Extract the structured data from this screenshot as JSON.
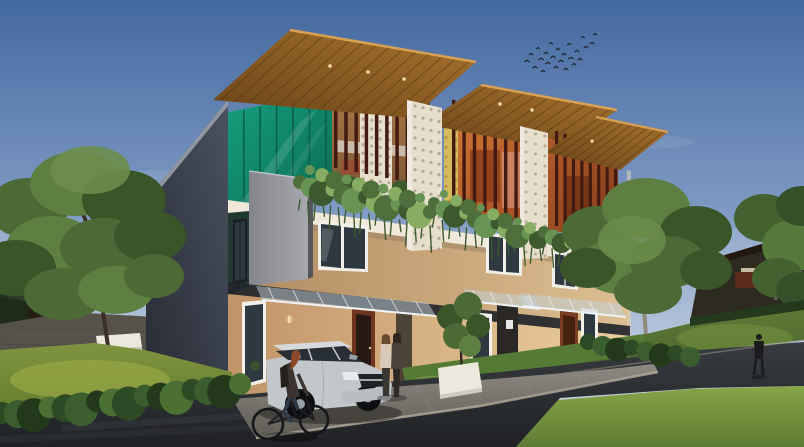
{
  "scene": {
    "type": "architectural-render",
    "description": "Exterior 3D rendering of a modern three-unit row house at dusk: rooftop wooden pergolas with maroon vertical louvers, teal glass panels, perforated breeze-block screens, hanging balcony vines, tan walls, dark slate side wall, glass entrance canopies, lawns and hedges, a silver SUV parked on the driveway, a cyclist on the road, two women at the entrance, a pedestrian on the far path and a flock of birds in the sky"
  },
  "palette": {
    "sky_top": "#44699f",
    "sky_mid": "#7b98c2",
    "sky_low": "#b9c9dc",
    "sky_horizon": "#cfd9e4",
    "cloud": "#ffffff",
    "bird": "#222a38",
    "ridge_dark": "#2d2a20",
    "ridge_top": "#211811",
    "distant_building": "#5a2b1d",
    "backdrop_tree": "#243420",
    "side_wall_top": "#4a5260",
    "side_wall_bottom": "#262a33",
    "roof_trim": "#99a0aa",
    "wood_light": "#a8742f",
    "wood_dark": "#6b4418",
    "wood_slat_line": "#53340f",
    "wood_fascia": "#d9a052",
    "louver": "#431a12",
    "teal_light": "#14a07e",
    "teal_dark": "#0c6b54",
    "teal_mullion": "#0a5844",
    "terrace1_warm": "#a87848",
    "terrace1_shadow": "#7c5636",
    "interior_orange": "#cf7a34",
    "interior_orange_dark": "#9a4420",
    "interior3_orange": "#b25a28",
    "interior3_dark": "#7e3a1a",
    "breeze_block": "#e7dfcb",
    "breeze_hole": "#a89f8a",
    "yellow_block": "#d4b95e",
    "yellow_hole": "#a8883a",
    "slab_white": "#f0e9da",
    "slab_shadow": "#9c8468",
    "gray_box_light": "#a6a8ad",
    "gray_box_dark": "#84868c",
    "tan_light": "#dcbf92",
    "tan_dark": "#b28a60",
    "gf_light": "#eccf9e",
    "gf_dark": "#c09468",
    "recess_dark": "#23262c",
    "awning_glass": "#c4d4de",
    "awning_frame": "#eef2f4",
    "door_maroon": "#70351f",
    "door_dark": "#2b2724",
    "window_frame": "#f2efe8",
    "window_glass": "#2e3840",
    "vine_a": "#4e6f3c",
    "vine_b": "#679454",
    "vine_c": "#3c5a2e",
    "vine_d": "#86ad62",
    "tree_a": "#4c6a36",
    "tree_b": "#5d7f42",
    "tree_c": "#3a5628",
    "tree_d": "#6b8d4a",
    "trunk_dark": "#3a2f24",
    "trunk_pale": "#8f897c",
    "lawn_left_hi": "#a3b148",
    "lawn_left": "#7f9440",
    "lawn_left_lo": "#667e2e",
    "lawn_right": "#5f7c38",
    "lawn_right_lo": "#49652c",
    "grass_front_hi": "#86a648",
    "grass_front_lo": "#5d7c33",
    "hedge_a": "#2c4a24",
    "hedge_b": "#3a5e2e",
    "hedge_c": "#223a1b",
    "hedge_hi": "#4a7034",
    "road_light": "#383c40",
    "road_dark": "#1f2124",
    "paver_light": "#8e8a82",
    "paver_dark": "#5f5c56",
    "curb": "#b5ad9e",
    "patio": "#56524a",
    "bench_white": "#ece8de",
    "car_silver_hi": "#d6dadd",
    "car_silver": "#c2c7cb",
    "car_silver_lo": "#9aa0a6",
    "car_glass": "#272e36",
    "car_tire": "#0d0e10",
    "skin": "#caa58a",
    "hair_red": "#8a4a28",
    "figure_dark": "#2c2824",
    "figure_light_top": "#d9c9b8",
    "lamp_glow": "#f5deaa"
  },
  "counts": {
    "birds": 24,
    "louvers_unit1": 10,
    "louvers_unit2": 11,
    "louvers_unit3": 8,
    "canopy1_slats": 14,
    "canopy2_slats": 11,
    "canopy3_slats": 9,
    "teal_mullions": 6,
    "left_hedge_bushes": 16,
    "right_hedge_bushes": 8
  },
  "birds": [
    [
      527,
      62,
      2.6
    ],
    [
      531,
      55,
      2.2
    ],
    [
      535,
      68,
      2.4
    ],
    [
      538,
      49,
      2.0
    ],
    [
      541,
      60,
      2.8
    ],
    [
      543,
      72,
      2.2
    ],
    [
      546,
      54,
      2.4
    ],
    [
      548,
      64,
      2.6
    ],
    [
      551,
      44,
      2.0
    ],
    [
      553,
      58,
      2.8
    ],
    [
      556,
      68,
      2.4
    ],
    [
      558,
      50,
      2.2
    ],
    [
      561,
      62,
      2.6
    ],
    [
      564,
      55,
      2.2
    ],
    [
      566,
      70,
      2.4
    ],
    [
      569,
      45,
      2.0
    ],
    [
      571,
      59,
      2.6
    ],
    [
      574,
      65,
      2.2
    ],
    [
      577,
      52,
      2.4
    ],
    [
      580,
      60,
      2.2
    ],
    [
      583,
      38,
      2.0
    ],
    [
      586,
      48,
      2.4
    ],
    [
      592,
      44,
      2.2
    ],
    [
      595,
      35,
      2.0
    ]
  ]
}
